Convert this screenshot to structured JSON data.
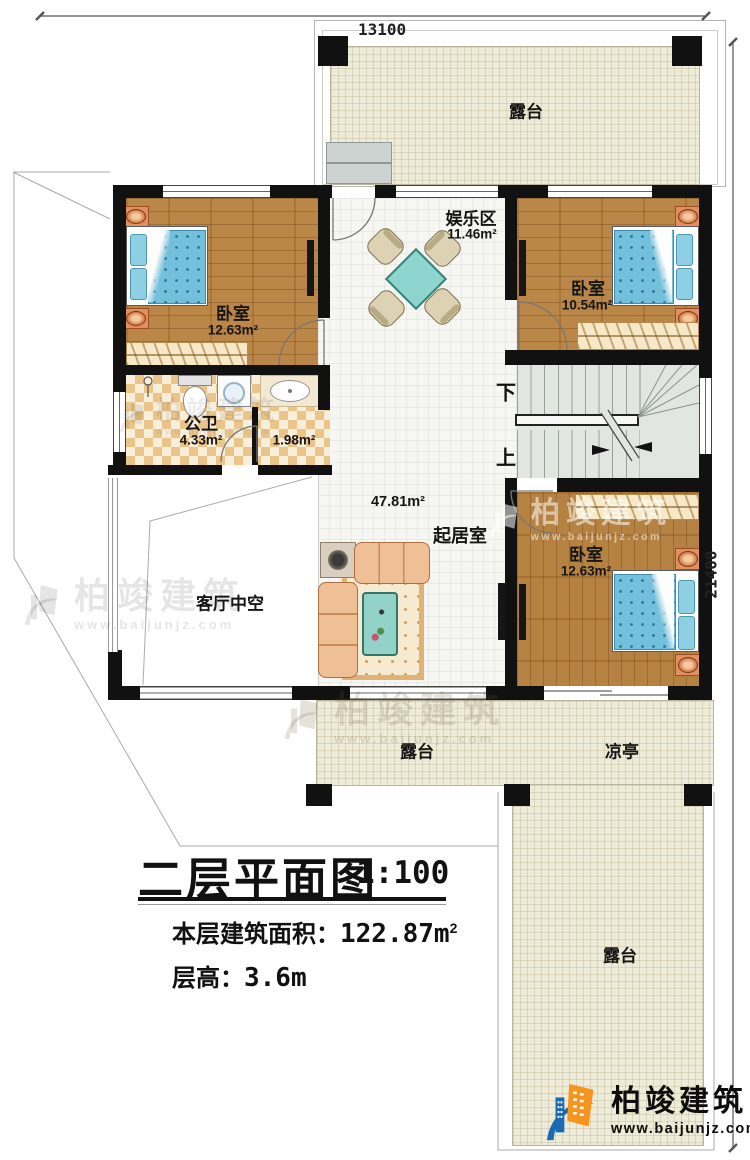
{
  "dims": {
    "top": "13100",
    "right": "21400"
  },
  "rooms": {
    "terrace_top": {
      "name": "露台"
    },
    "bedroom_left": {
      "name": "卧室",
      "area": "12.63m²"
    },
    "entertainment": {
      "name": "娱乐区",
      "area": "11.46m²"
    },
    "bedroom_top_right": {
      "name": "卧室",
      "area": "10.54m²"
    },
    "bathroom": {
      "name": "公卫",
      "area": "4.33m²"
    },
    "laundry": {
      "area": "1.98m²"
    },
    "living": {
      "name": "起居室",
      "area": "47.81m²"
    },
    "void": {
      "name": "客厅中空"
    },
    "terrace_bottom": {
      "name": "露台"
    },
    "pavilion": {
      "name": "凉亭"
    },
    "terrace_right": {
      "name": "露台"
    }
  },
  "stairs": {
    "down": "下",
    "up": "上"
  },
  "title": {
    "main": "二层平面图",
    "scale": "1:100",
    "area_label": "本层建筑面积：",
    "area_value": "122.87m",
    "area_exp": "2",
    "floor_label": "层高：",
    "floor_value": "3.6m"
  },
  "brand": {
    "name": "柏竣建筑",
    "url": "www.baijunjz.com"
  }
}
